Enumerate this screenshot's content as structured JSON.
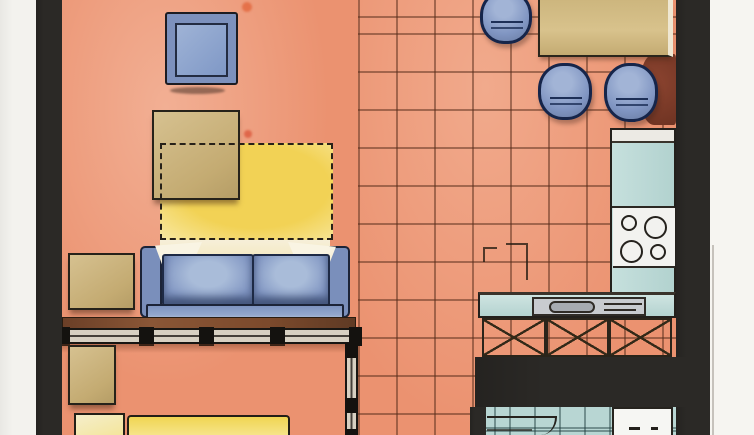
{
  "document": {
    "kind": "hand-drawn watercolor apartment floor plan (scanned)",
    "visible_text": "",
    "orientation": "plan view, cropped top and bottom"
  },
  "colors": {
    "paper": "#f3f2ee",
    "paper_right": "#f6f5f1",
    "wall": "#2b2926",
    "floor": "#eb9270",
    "tile_line": "rgba(86,44,26,0.5)",
    "rug_yellow": "#f2d255",
    "furniture_blue": "#8095c2",
    "blue_dark": "#1e2a45",
    "wood_tan": "#ccb57f",
    "counter_teal": "#bedbd8",
    "console_brown": "#7c4a2e",
    "accent_dark_red": "#82402c",
    "bathroom_teal": "#b8d6d3",
    "stove_white": "#f2f2ef",
    "bed_yellow": "#f2d75e",
    "pillow_cream": "#f4ebca"
  },
  "rooms": [
    {
      "id": "living-area",
      "floor": "plain salmon wash"
    },
    {
      "id": "kitchen-dining-area",
      "floor": "salmon tile grid ~38px"
    },
    {
      "id": "sleeping-area",
      "floor": "plain salmon wash"
    },
    {
      "id": "bathroom",
      "floor": "teal tile grid ~25px"
    }
  ],
  "furniture": [
    {
      "id": "armchair",
      "color": "blue"
    },
    {
      "id": "coffee-table",
      "color": "tan"
    },
    {
      "id": "area-rug",
      "color": "yellow, dashed outline"
    },
    {
      "id": "side-table",
      "color": "tan"
    },
    {
      "id": "sofa",
      "color": "blue, two seat cushions, two light pillows"
    },
    {
      "id": "console-ledge",
      "color": "brown"
    },
    {
      "id": "glazed-partition",
      "color": "black posts"
    },
    {
      "id": "nightstand",
      "color": "tan"
    },
    {
      "id": "bed",
      "color": "yellow blanket, cream pillow"
    },
    {
      "id": "dining-table",
      "color": "tan"
    },
    {
      "id": "stool-top",
      "color": "blue round"
    },
    {
      "id": "stool-left",
      "color": "blue round"
    },
    {
      "id": "stool-right",
      "color": "blue round"
    },
    {
      "id": "dark-red-mat",
      "color": "dark red"
    },
    {
      "id": "kitchen-counter-right",
      "color": "teal"
    },
    {
      "id": "cooktop",
      "burners": 4
    },
    {
      "id": "kitchen-counter-bottom",
      "color": "teal with sink"
    },
    {
      "id": "base-cabinets",
      "panels": 3,
      "pattern": "X-hatched"
    },
    {
      "id": "washer",
      "color": "white"
    },
    {
      "id": "door-swing",
      "location": "bathroom"
    }
  ]
}
